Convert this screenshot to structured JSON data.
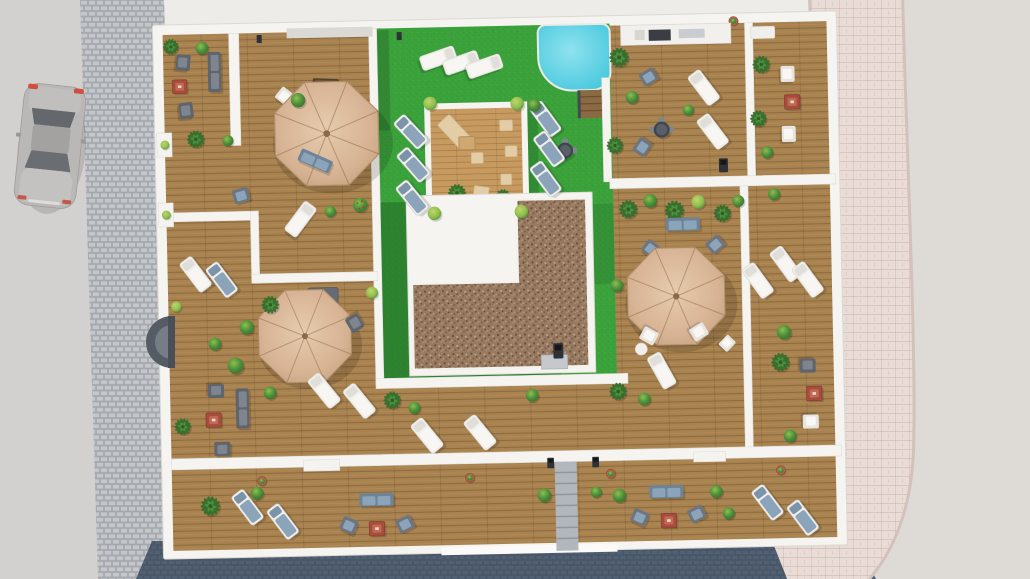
{
  "scene": {
    "type": "architectural-3d-aerial-render",
    "description": "Aerial 3D rendering of a residential building rooftop terrace: wooden deck terraces around a central lawn with plunge pool, wooden chill-out platform, gravel core roof, three tan parasols, sun loungers, gray lounge sets with red coffee tables, planting, surrounding streets with a parked car, paved sidewalks and an entrance canopy.",
    "palette": {
      "road": "#d2d1cf",
      "sidewalk": "#b6b9bd",
      "sidewalkStone": "#c3c6ca",
      "street": "#5d6a7a",
      "streetStone": "#526073",
      "plaza": "#dedbd6",
      "paver": "#e9dcd6",
      "parapet": "#f5f4f0",
      "wood": "#a8824f",
      "woodPlatform": "#c79a5f",
      "lawn": "#3ba23b",
      "lawnShade": "#1f6126",
      "pool": "#46c8dc",
      "poolLight": "#8fe2ef",
      "pebble": "#96795f",
      "umbrella": "#d7b394",
      "furnGray": "#5f656d",
      "furnGrayLight": "#7e858e",
      "cushionBlue": "#8ba4b9",
      "furnWhite": "#f0efeb",
      "tableRed": "#a74d3e",
      "tableRedLight": "#c26854",
      "plant": "#4c8f3b",
      "plantDark": "#356f2d",
      "plantLight": "#8fbf4e",
      "plantYellow": "#c3d46c",
      "pot": "#b2644c",
      "carBody": "#b9b8b6",
      "glass": "#64676c",
      "stair": "#b2b7be",
      "vent": "#c5c9ce"
    },
    "inventory": {
      "parasols": 3,
      "sun_loungers": 27,
      "lounge_armchairs": 16,
      "sofas": 6,
      "red_coffee_tables": 6,
      "round_bistro_tables": 3,
      "outdoor_kitchen": 1,
      "braziers": 3,
      "pool": 1,
      "pool_steps": 1,
      "wooden_platform": 1,
      "gravel_roof_section": 1,
      "lawn_area": 1,
      "planter_pots": 5,
      "parapet_planters": 2,
      "shrubs": 38,
      "palm_plants": 17,
      "parked_cars": 1,
      "entrance_canopy": 1,
      "service_stair": 1
    }
  }
}
